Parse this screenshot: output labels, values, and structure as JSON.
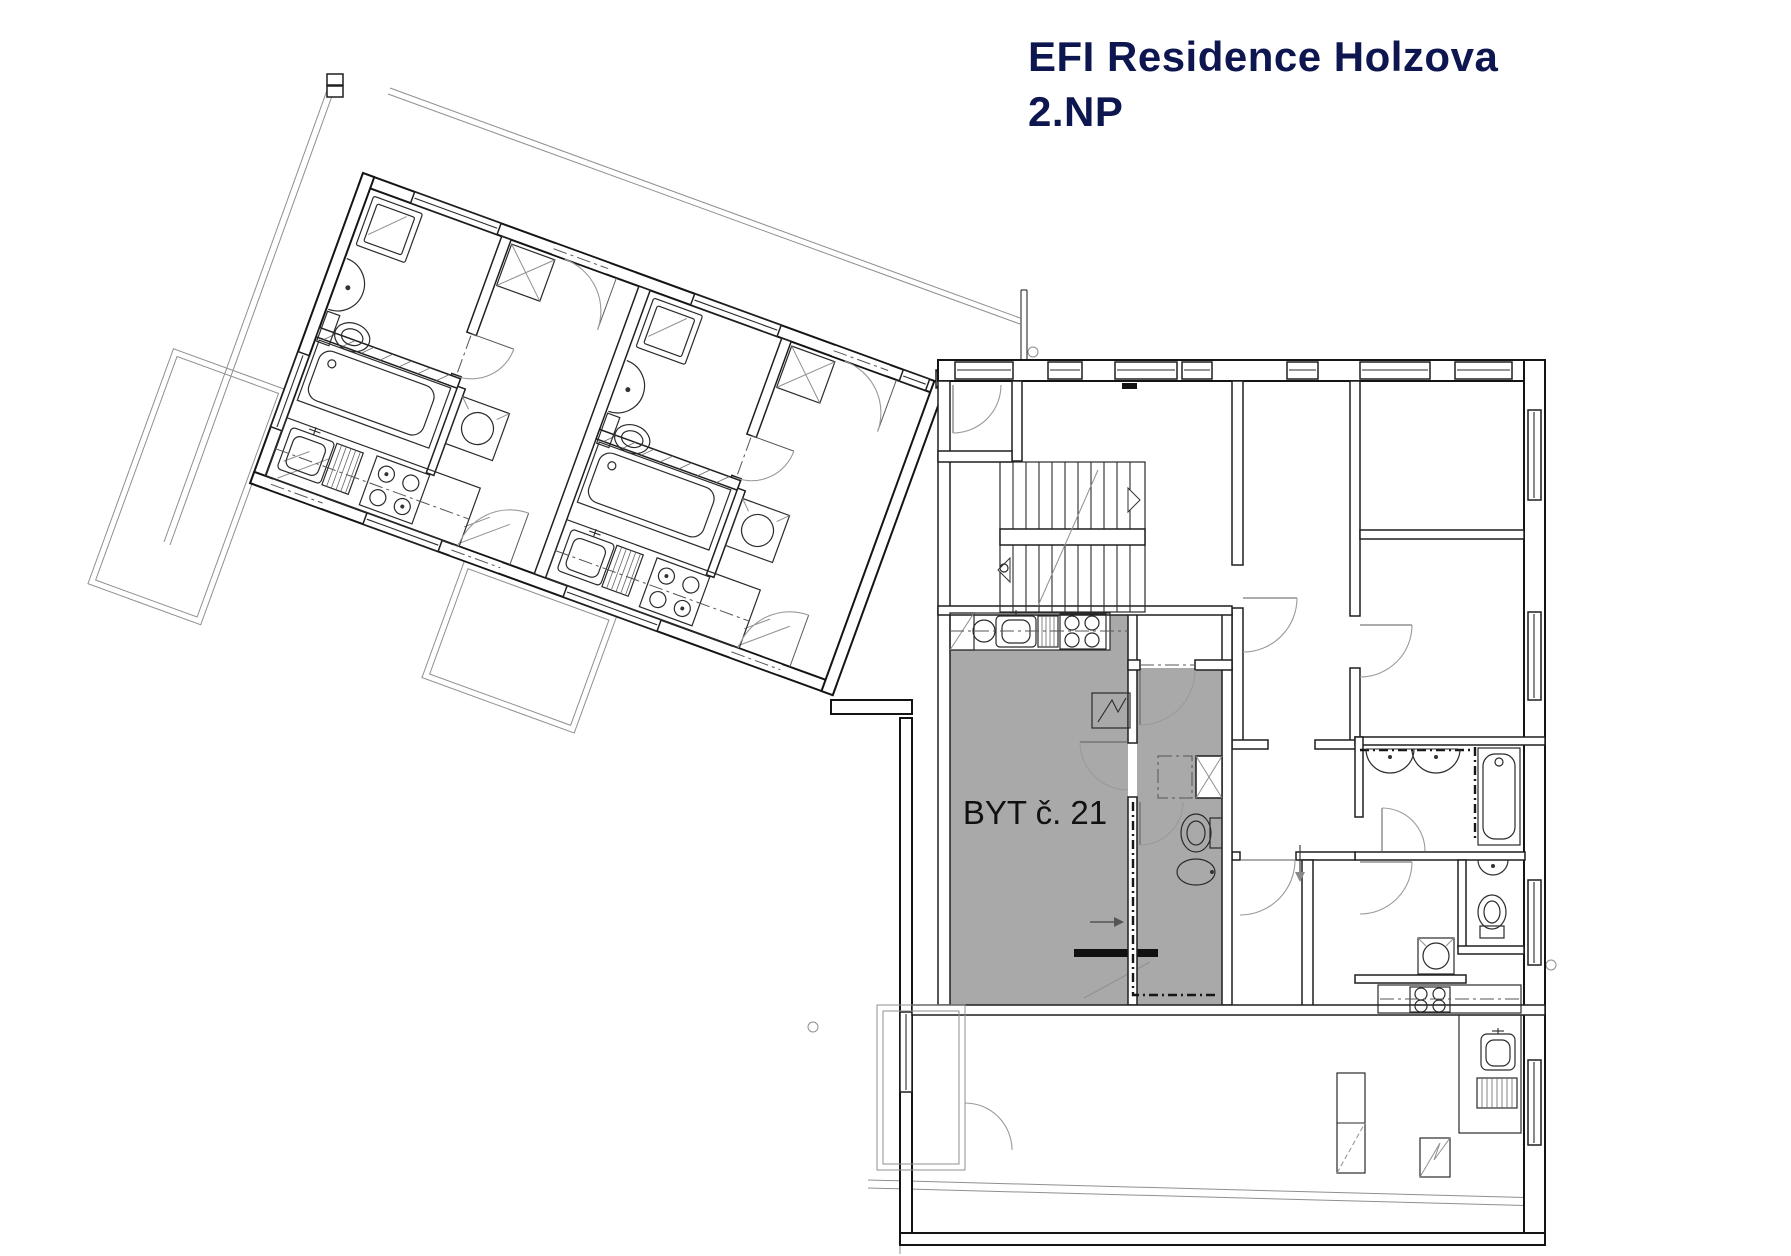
{
  "header": {
    "title_line1": "EFI Residence Holzova",
    "title_line2": "2.NP"
  },
  "plan": {
    "highlighted_apartment": {
      "label": "BYT č. 21",
      "fill_color": "#a9a9a9"
    },
    "colors": {
      "background": "#ffffff",
      "walls": "#1f1f1f",
      "title_text": "#0e1650",
      "door_arc": "#9a9a9a"
    }
  }
}
